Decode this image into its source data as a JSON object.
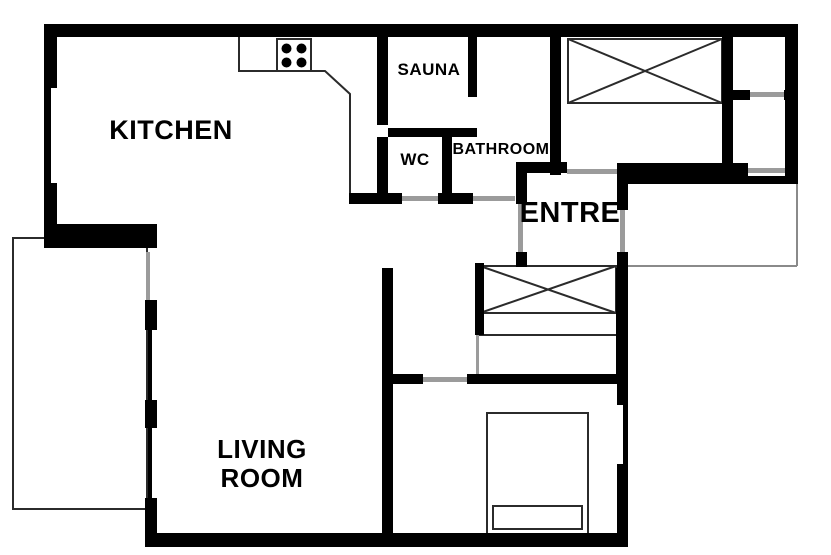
{
  "rooms": {
    "kitchen": "KITCHEN",
    "sauna": "SAUNA",
    "wc": "WC",
    "bathroom": "BATHROOM",
    "entre": "ENTRE",
    "living": [
      "LIVING",
      "ROOM"
    ]
  },
  "colors": {
    "wall": "#000000",
    "door_opening": "#9b9b9b",
    "furniture_outline": "#2b2b2b",
    "terrace_outline": "#8a8a8a",
    "background": "#ffffff"
  }
}
